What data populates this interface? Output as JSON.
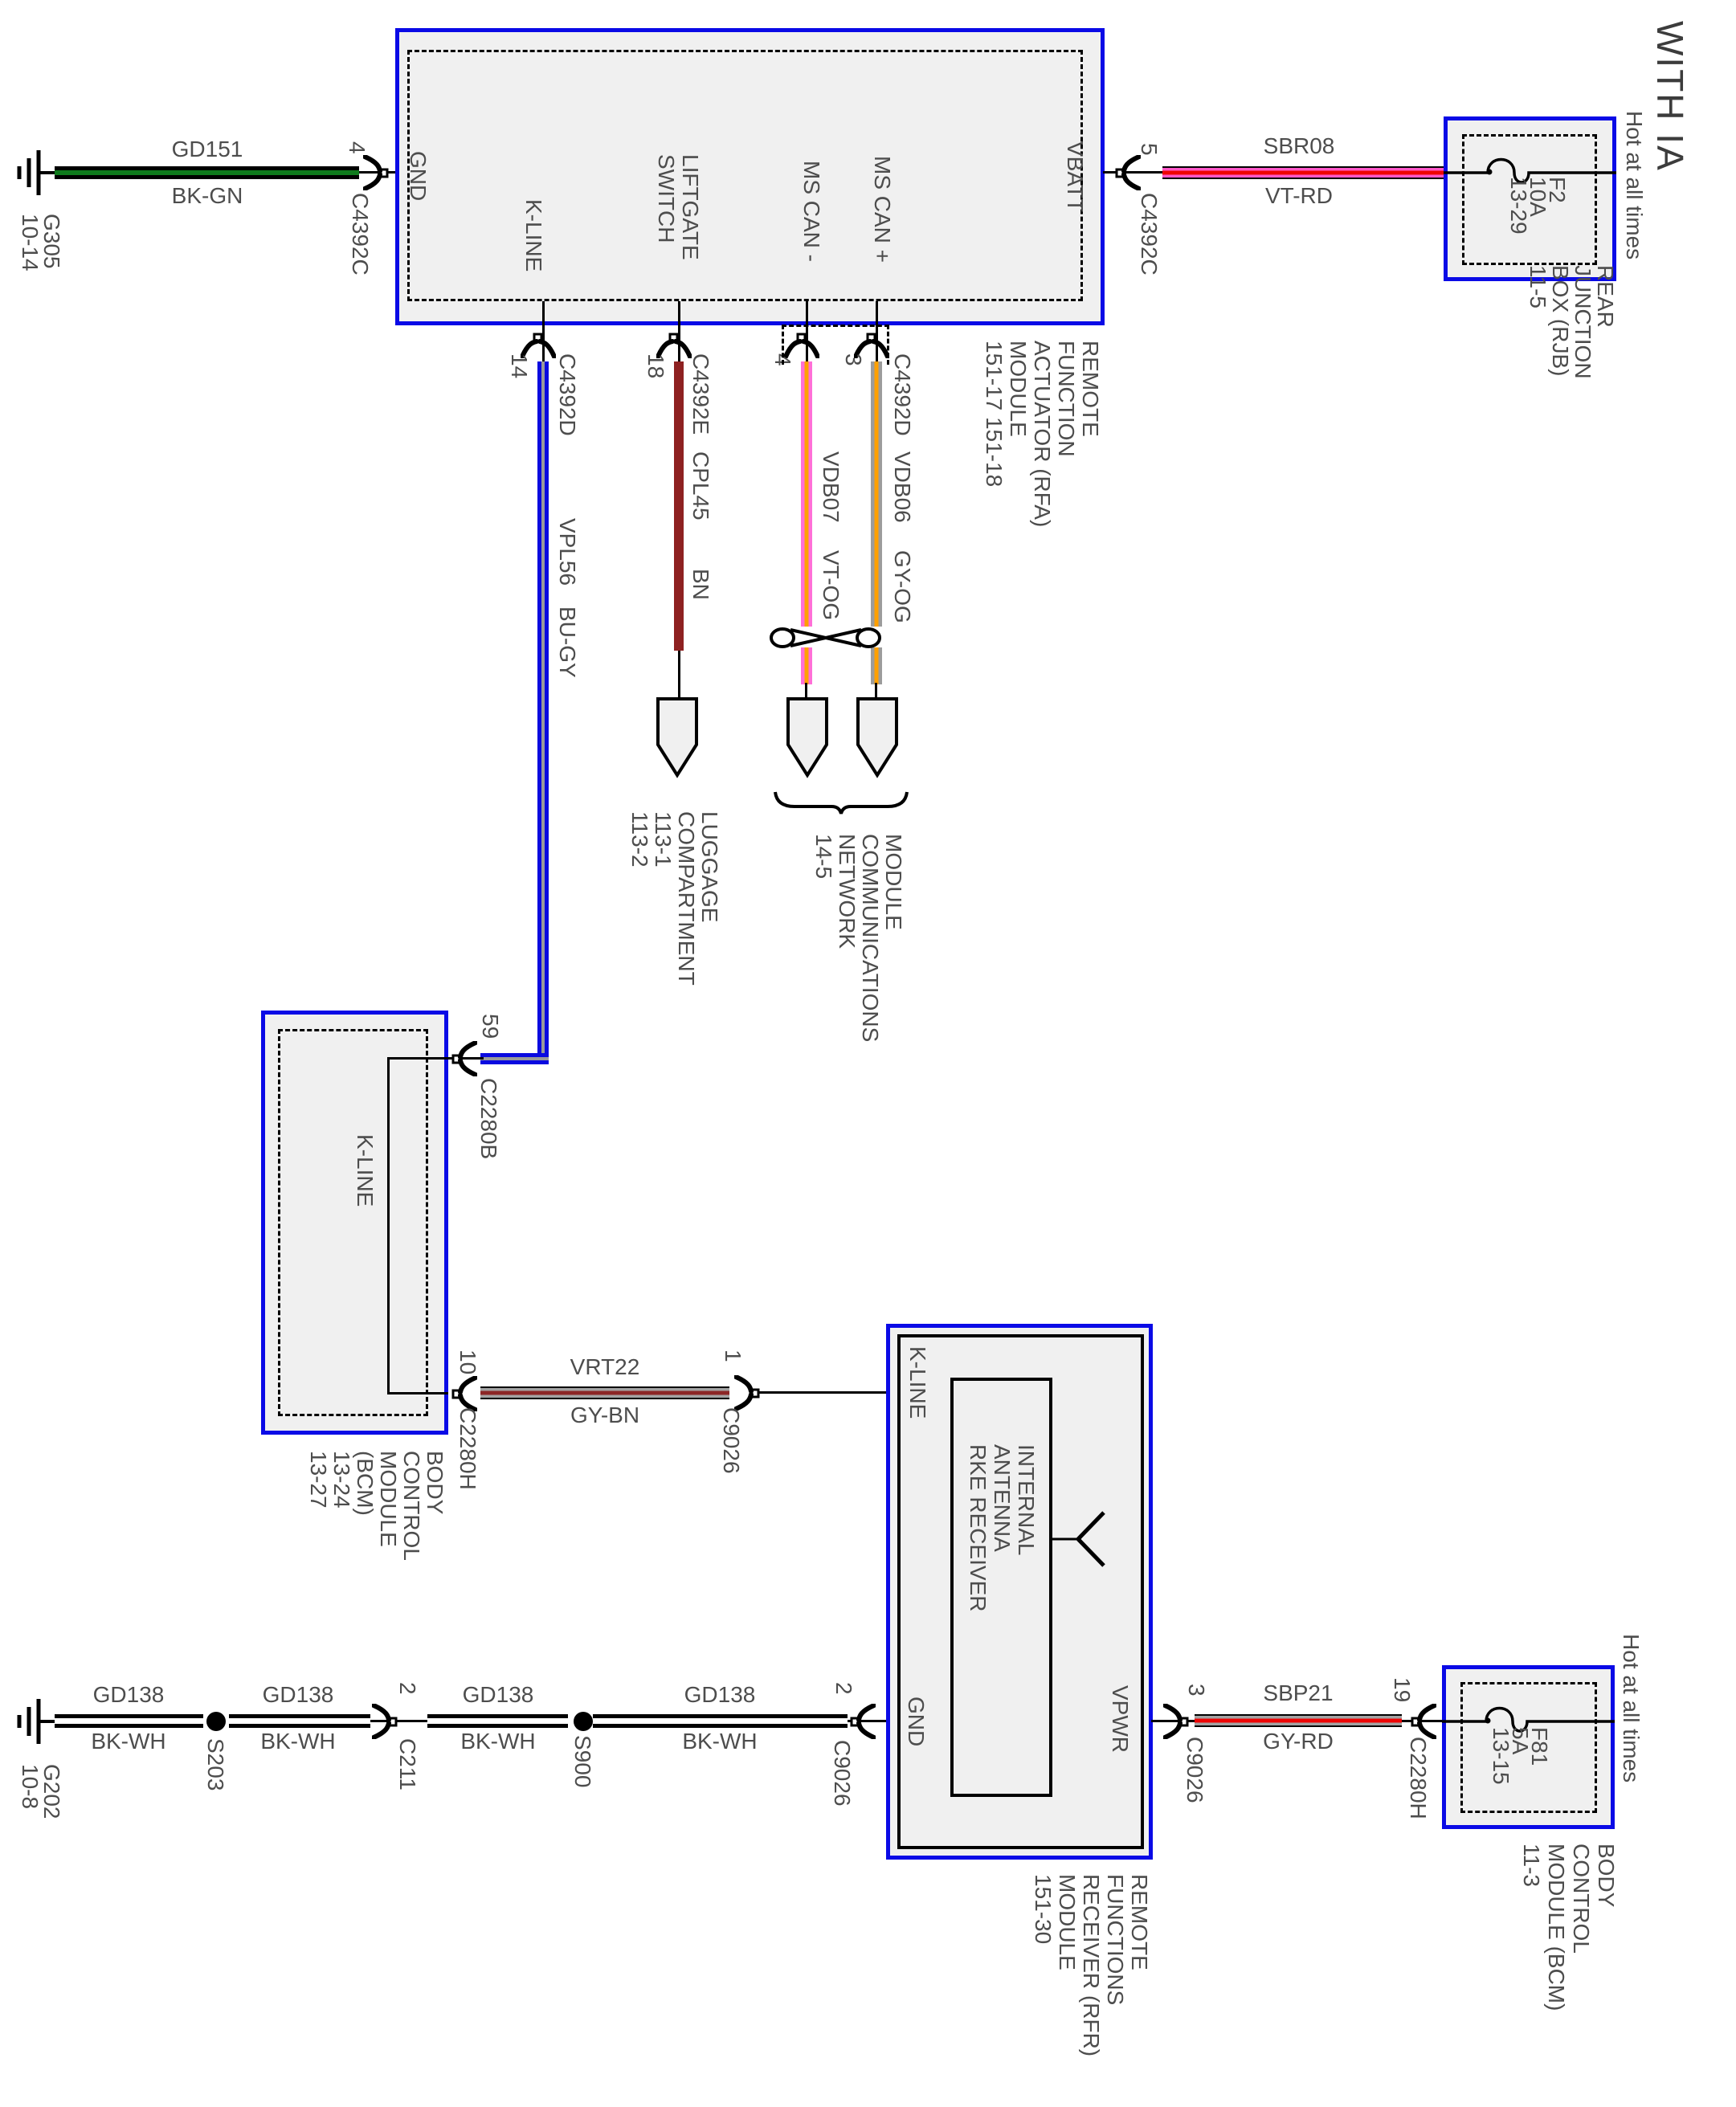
{
  "title": "WITH IA",
  "colors": {
    "highlight_blue": "#0a0ae6",
    "module_fill": "#f0f0f0",
    "wire_black": "#000000",
    "wire_green": "#0e7a1c",
    "wire_pink_violet": "#ff57c8",
    "wire_red": "#ee0404",
    "wire_blue": "#0a0ae0",
    "wire_gray": "#9a9a9a",
    "wire_brown": "#8e2121",
    "wire_orange": "#ffa000",
    "text_gray": "#4d4d4d"
  },
  "icons": {
    "ground": "ground-icon",
    "connector_arrow": "connector-arrow-icon",
    "splice": "splice-dot-icon",
    "fuse": "fuse-icon",
    "antenna": "antenna-icon",
    "brace": "brace-icon",
    "twisted_pair": "twisted-pair-icon",
    "inline_connector": "inline-connector-icon"
  },
  "top": {
    "ground": {
      "id_lines": [
        "G305",
        "10-14"
      ]
    },
    "wire_gd151": {
      "name": "GD151",
      "color": "BK-GN"
    },
    "conn_gnd": {
      "pin": "4",
      "id": "C4392C"
    },
    "rfa": {
      "pin_gnd": "GND",
      "pin_kline": "K-LINE",
      "pin_liftgate": [
        "LIFTGATE",
        "SWITCH"
      ],
      "pin_mscan_minus": "MS CAN -",
      "pin_mscan_plus": "MS CAN +",
      "pin_vbatt": "VBATT",
      "label": [
        "REMOTE",
        "FUNCTION",
        "ACTUATOR (RFA)",
        "MODULE",
        "151-17  151-18"
      ]
    },
    "conn_vbatt": {
      "pin": "5",
      "id": "C4392C"
    },
    "wire_sbr08": {
      "name": "SBR08",
      "color": "VT-RD"
    },
    "rjb": {
      "hot": "Hot at all times",
      "fuse": [
        "F2",
        "10A",
        "13-29"
      ],
      "label": [
        "REAR",
        "JUNCTION",
        "BOX (RJB)",
        "11-5"
      ]
    }
  },
  "drops": {
    "kline": {
      "pin": "14",
      "conn": "C4392D",
      "name": "VPL56",
      "color": "BU-GY"
    },
    "liftgate": {
      "pin": "18",
      "conn": "C4392E",
      "name": "CPL45",
      "color": "BN",
      "dest": [
        "LUGGAGE",
        "COMPARTMENT",
        "113-1",
        "113-2"
      ]
    },
    "mscan_minus": {
      "pin": "4",
      "name": "VDB07",
      "color": "VT-OG"
    },
    "mscan_plus": {
      "pin": "3",
      "conn": "C4392D",
      "name": "VDB06",
      "color": "GY-OG"
    },
    "network": [
      "MODULE",
      "COMMUNICATIONS",
      "NETWORK",
      "14-5"
    ]
  },
  "bcm": {
    "in_pin": "59",
    "in_conn": "C2280B",
    "pin_label": "K-LINE",
    "label": [
      "BODY",
      "CONTROL",
      "MODULE",
      "(BCM)",
      "13-24",
      "13-27"
    ],
    "out_pin": "10",
    "out_conn": "C2280H"
  },
  "link": {
    "wire": {
      "name": "VRT22",
      "color": "GY-BN"
    },
    "rfr_pin": "1",
    "rfr_conn": "C9026"
  },
  "rfr": {
    "pin_kline": "K-LINE",
    "pin_gnd": "GND",
    "pin_vpwr": "VPWR",
    "inner": [
      "INTERNAL",
      "ANTENNA",
      "RKE RECEIVER"
    ],
    "label": [
      "REMOTE",
      "FUNCTIONS",
      "RECEIVER (RFR)",
      "MODULE",
      "151-30"
    ]
  },
  "gnd_chain": {
    "ground": [
      "G202",
      "10-8"
    ],
    "wire": {
      "name": "GD138",
      "color": "BK-WH"
    },
    "s203": "S203",
    "c211": {
      "pin": "2",
      "id": "C211"
    },
    "s900": "S900",
    "c9026": {
      "pin": "2",
      "id": "C9026"
    }
  },
  "pwr_chain": {
    "c9026": {
      "pin": "3",
      "id": "C9026"
    },
    "wire": {
      "name": "SBP21",
      "color": "GY-RD"
    },
    "c2280h": {
      "pin": "19",
      "id": "C2280H"
    },
    "bcm_fuse": {
      "hot": "Hot at all times",
      "fuse": [
        "F81",
        "5A",
        "13-15"
      ],
      "label": [
        "BODY",
        "CONTROL",
        "MODULE (BCM)",
        "11-3"
      ]
    }
  }
}
